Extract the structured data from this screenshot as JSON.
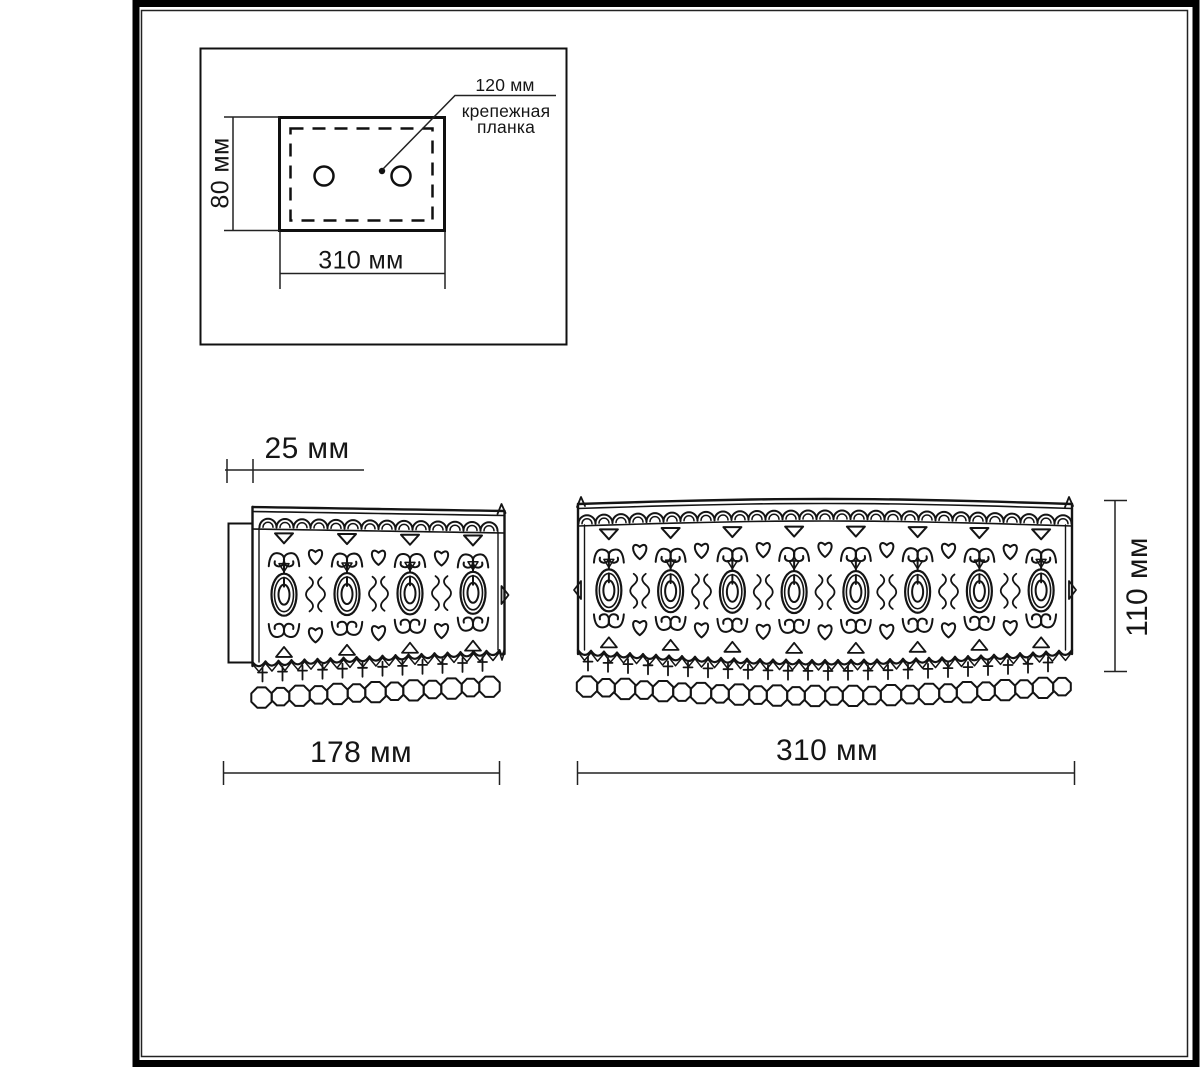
{
  "inset": {
    "callout_value": "120 мм",
    "callout_name_line1": "крепежная",
    "callout_name_line2": "планка",
    "height_label": "80 мм",
    "width_label": "310 мм"
  },
  "side_view": {
    "depth_label": "25 мм",
    "width_label": "178 мм"
  },
  "front_view": {
    "width_label": "310 мм",
    "height_label": "110 мм"
  },
  "colors": {
    "line": "#141414",
    "background": "#ffffff"
  }
}
